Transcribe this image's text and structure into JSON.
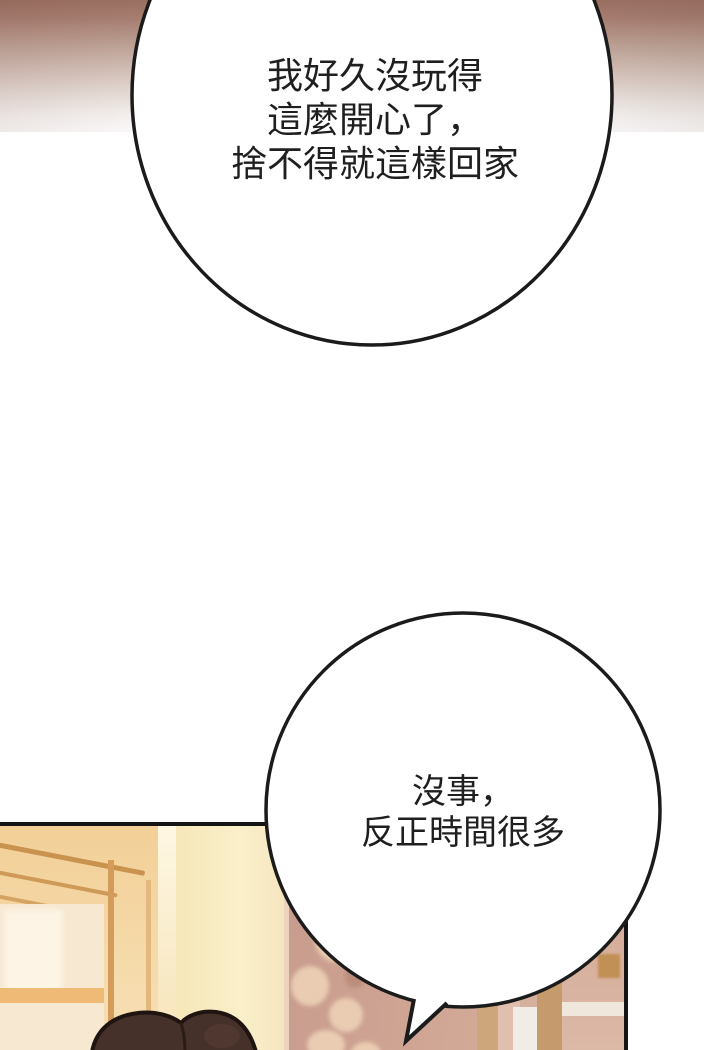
{
  "page": {
    "width": 704,
    "height": 1050,
    "kind": "webtoon-comic-panel"
  },
  "speech_bubbles": [
    {
      "id": "bubble-1",
      "lines": [
        "我好久沒玩得",
        "這麼開心了，",
        "捨不得就這樣回家"
      ]
    },
    {
      "id": "bubble-2",
      "lines": [
        "沒事，",
        "反正時間很多"
      ]
    }
  ],
  "colors": {
    "bubble_fill": "#ffffff",
    "bubble_border": "#1b1b1b",
    "text": "#1f1f1f",
    "top_gradient_start": "#9c7164",
    "top_gradient_end": "#ffffff",
    "panel_border": "#141414",
    "wall_yellow": "#f8ecc2",
    "door_orange": "#f1cf96",
    "curtain_mauve": "#cba193",
    "hair_brown": "#46302a"
  }
}
